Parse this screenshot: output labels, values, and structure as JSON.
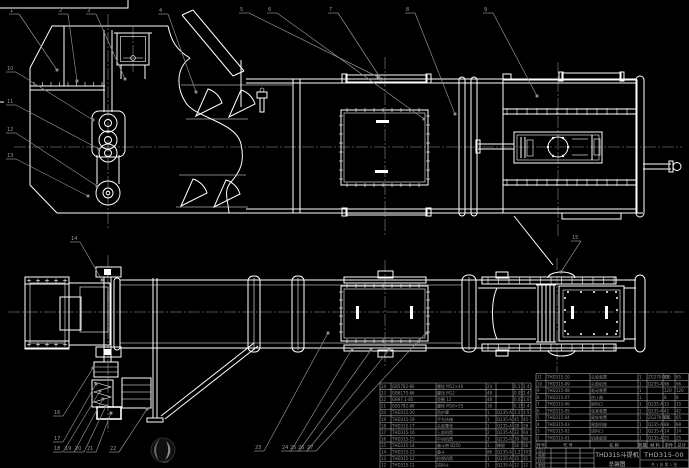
{
  "colors": {
    "background": "#000000",
    "line": "#ffffff",
    "leader": "#8f8f8f",
    "table_line": "#b8b8b8",
    "table_text": "#949494",
    "title_text": "#bdbdbd"
  },
  "title_block": {
    "product_title": "THD315斗提机",
    "drawing_type": "总装图",
    "drawing_number": "THD315-00",
    "approval_rows": [
      "设计",
      "制图",
      "校对",
      "审核"
    ],
    "sheet_note": "共 1 张  第 1 张"
  },
  "bom": {
    "header": [
      "件号",
      "代 号",
      "名 称",
      "数量",
      "材 料",
      "单件",
      "总计"
    ],
    "left_rows": [
      [
        "24",
        "GB5782-86",
        "螺栓 M12×40",
        "24",
        "",
        "0.1",
        "2.4"
      ],
      [
        "23",
        "GB6170-86",
        "螺母 M12",
        "48",
        "",
        "0.05",
        "2.4"
      ],
      [
        "22",
        "GB97.1-85",
        "垫圈 12",
        "48",
        "",
        "0.02",
        "1.0"
      ],
      [
        "21",
        "GB5782-86",
        "螺栓 M16×55",
        "16",
        "",
        "0.15",
        "2.4"
      ],
      [
        "20",
        "THD315-20",
        "防护罩",
        "1",
        "Q235-A",
        "3.5",
        "3.5"
      ],
      [
        "19",
        "THD315-19",
        "平台扶梯",
        "1",
        "Q235-A",
        "45",
        "45"
      ],
      [
        "18",
        "THD315-17",
        "头部罩壳",
        "1",
        "Q235-A",
        "28",
        "28"
      ],
      [
        "17",
        "THD315-16",
        "上部机筒",
        "2",
        "Q235-A",
        "32",
        "64"
      ],
      [
        "16",
        "THD315-15",
        "中间机筒",
        "3",
        "Q235-A",
        "30",
        "90"
      ],
      [
        "15",
        "THD315-14",
        "畚斗带 B250",
        "1",
        "橡胶",
        "56",
        "56"
      ],
      [
        "14",
        "THD315-13",
        "畚斗",
        "86",
        "Q235-A",
        "1.2",
        "103"
      ],
      [
        "13",
        "THD315-12",
        "检视机筒",
        "1",
        "Q235-A",
        "35",
        "35"
      ],
      [
        "12",
        "THD315-11",
        "进料斗",
        "1",
        "Q235-A",
        "12",
        "12"
      ]
    ],
    "right_rows": [
      [
        "11",
        "THD315-10",
        "头轮装置",
        "1",
        "ZG270-500",
        "85",
        "85"
      ],
      [
        "10",
        "THD315-09",
        "头部机壳",
        "1",
        "Q235-A",
        "96",
        "96"
      ],
      [
        "9",
        "THD315-08",
        "驱动装置",
        "1",
        "",
        "120",
        "120"
      ],
      [
        "8",
        "THD315-07",
        "逆止器",
        "1",
        "",
        "8",
        "8"
      ],
      [
        "7",
        "THD315-06",
        "卸料口",
        "1",
        "Q235-A",
        "15",
        "15"
      ],
      [
        "6",
        "THD315-05",
        "张紧装置",
        "1",
        "Q235-A",
        "42",
        "42"
      ],
      [
        "5",
        "THD315-04",
        "尾轮装置",
        "1",
        "ZG270-500",
        "65",
        "65"
      ],
      [
        "4",
        "THD315-03",
        "尾部机座",
        "1",
        "Q235-A",
        "88",
        "88"
      ],
      [
        "3",
        "THD315-02",
        "进料口",
        "1",
        "Q235-A",
        "14",
        "14"
      ],
      [
        "2",
        "THD315-01",
        "机座底架",
        "1",
        "Q235-A",
        "25",
        "25"
      ]
    ]
  },
  "balloons": [
    {
      "n": "1",
      "x": 10,
      "y": 8,
      "tx": 57,
      "ty": 70
    },
    {
      "n": "2",
      "x": 59,
      "y": 8,
      "tx": 77,
      "ty": 81
    },
    {
      "n": "3",
      "x": 87,
      "y": 8,
      "tx": 125,
      "ty": 79
    },
    {
      "n": "4",
      "x": 159,
      "y": 8,
      "tx": 196,
      "ty": 92
    },
    {
      "n": "5",
      "x": 240,
      "y": 7,
      "tx": 378,
      "ty": 77
    },
    {
      "n": "6",
      "x": 268,
      "y": 7,
      "tx": 424,
      "ty": 119
    },
    {
      "n": "7",
      "x": 329,
      "y": 7,
      "tx": 381,
      "ty": 79
    },
    {
      "n": "8",
      "x": 406,
      "y": 7,
      "tx": 455,
      "ty": 114
    },
    {
      "n": "9",
      "x": 484,
      "y": 7,
      "tx": 537,
      "ty": 96
    },
    {
      "n": "10",
      "x": 7,
      "y": 66,
      "tx": 93,
      "ty": 120
    },
    {
      "n": "11",
      "x": 7,
      "y": 99,
      "tx": 99,
      "ty": 149
    },
    {
      "n": "12",
      "x": 7,
      "y": 127,
      "tx": 97,
      "ty": 186
    },
    {
      "n": "13",
      "x": 7,
      "y": 153,
      "tx": 88,
      "ty": 196
    },
    {
      "n": "14",
      "x": 71,
      "y": 236,
      "tx": 102,
      "ty": 280
    },
    {
      "n": "15",
      "x": 572,
      "y": 235,
      "tx": 561,
      "ty": 272
    },
    {
      "n": "16",
      "x": 54,
      "y": 410,
      "tx": 93,
      "ty": 368
    },
    {
      "n": "17",
      "x": 54,
      "y": 436,
      "tx": 96,
      "ty": 384
    },
    {
      "n": "18",
      "x": 54,
      "y": 446,
      "tx": 100,
      "ty": 391
    },
    {
      "n": "19",
      "x": 65,
      "y": 446,
      "tx": 103,
      "ty": 399
    },
    {
      "n": "20",
      "x": 75,
      "y": 446,
      "tx": 106,
      "ty": 406
    },
    {
      "n": "21",
      "x": 87,
      "y": 446,
      "tx": 111,
      "ty": 413
    },
    {
      "n": "22",
      "x": 110,
      "y": 446,
      "tx": 147,
      "ty": 409
    },
    {
      "n": "23",
      "x": 255,
      "y": 445,
      "tx": 328,
      "ty": 333
    },
    {
      "n": "24",
      "x": 282,
      "y": 445,
      "tx": 352,
      "ty": 349
    },
    {
      "n": "25",
      "x": 290,
      "y": 445,
      "tx": 371,
      "ty": 350
    },
    {
      "n": "26",
      "x": 298,
      "y": 445,
      "tx": 389,
      "ty": 350
    },
    {
      "n": "27",
      "x": 307,
      "y": 445,
      "tx": 426,
      "ty": 333
    }
  ],
  "watermark": {
    "label": "logo-watermark"
  }
}
